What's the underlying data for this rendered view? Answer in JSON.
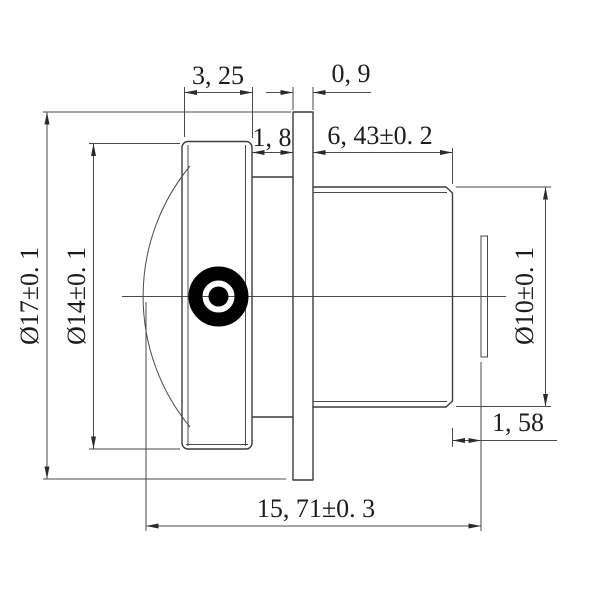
{
  "drawing": {
    "kind": "lens-barrel-technical-drawing",
    "dims": {
      "front_length": "3, 25",
      "flange_thickness": "0, 9",
      "neck_length": "1, 8",
      "rear_length": "6, 43±0. 2",
      "outer_diameter": "Ø17±0. 1",
      "front_diameter": "Ø14±0. 1",
      "rear_diameter": "Ø10±0. 1",
      "back_distance": "1, 58",
      "total_length": "15, 71±0. 3"
    },
    "colors": {
      "line": "#3c3c3c",
      "dimension": "#4a4a4a",
      "text": "#1c1c1c",
      "target": "#000000",
      "background": "#ffffff"
    }
  }
}
